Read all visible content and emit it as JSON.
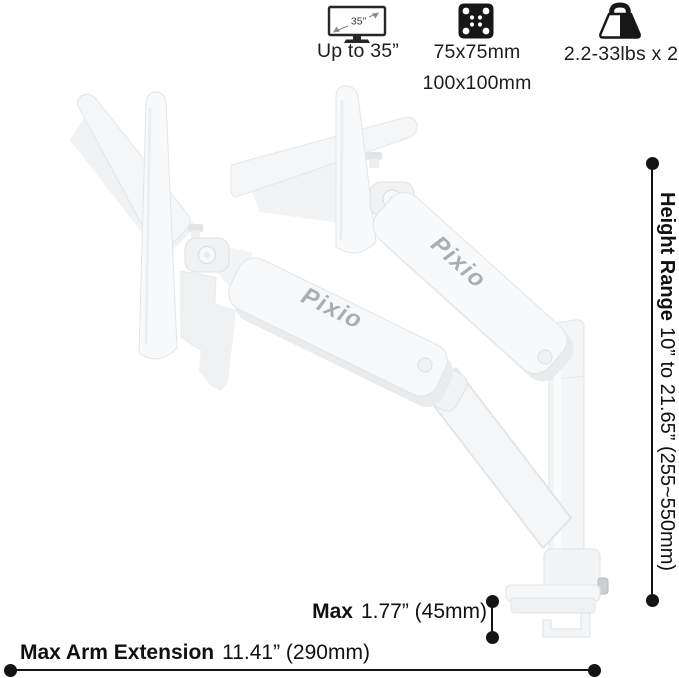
{
  "specs": {
    "screen": {
      "icon_inner_label": "35”",
      "caption": "Up to 35”"
    },
    "vesa": {
      "caption_line1": "75x75mm",
      "caption_line2": "100x100mm"
    },
    "weight": {
      "caption": "2.2-33lbs x 2"
    }
  },
  "product": {
    "brand_left": "Pixio",
    "brand_right": "Pixio",
    "body_color": "#f7f8f9",
    "shade_color": "#e9ebed",
    "edge_color": "#e2e4e6",
    "brand_text_color": "#a9aeb2"
  },
  "dimensions": {
    "height_range": {
      "label": "Height Range",
      "value": "10” to 21.65” (255~550mm)"
    },
    "clamp": {
      "label": "Max",
      "value": "1.77” (45mm)"
    },
    "extension": {
      "label": "Max Arm Extension",
      "value": "11.41” (290mm)"
    },
    "line_color": "#141414"
  }
}
